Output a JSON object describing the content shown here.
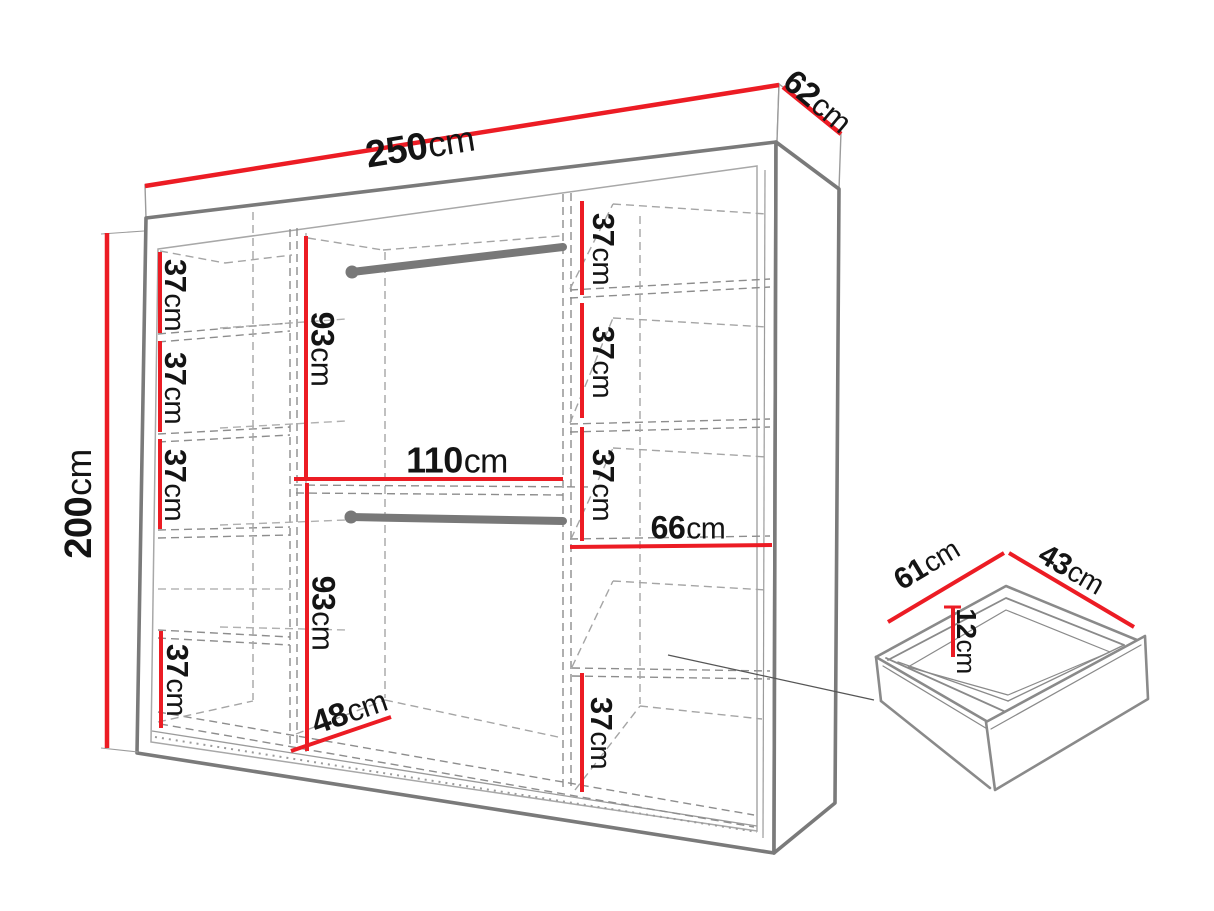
{
  "diagram_title": "wardrobe-dimension-diagram",
  "colors": {
    "dimension_red": "#ec1c24",
    "outline_gray": "#7a7a7a",
    "dash_gray": "#8d8d8d",
    "text_black": "#141414",
    "background": "#ffffff"
  },
  "wardrobe": {
    "width": {
      "num": "250",
      "unit": "cm"
    },
    "depth": {
      "num": "62",
      "unit": "cm"
    },
    "height": {
      "num": "200",
      "unit": "cm"
    },
    "left_column_shelves": [
      {
        "num": "37",
        "unit": "cm"
      },
      {
        "num": "37",
        "unit": "cm"
      },
      {
        "num": "37",
        "unit": "cm"
      },
      {
        "num": "37",
        "unit": "cm"
      }
    ],
    "middle_column": {
      "upper_height": {
        "num": "93",
        "unit": "cm"
      },
      "lower_height": {
        "num": "93",
        "unit": "cm"
      },
      "width": {
        "num": "110",
        "unit": "cm"
      },
      "floor_depth": {
        "num": "48",
        "unit": "cm"
      }
    },
    "right_column_shelves": [
      {
        "num": "37",
        "unit": "cm"
      },
      {
        "num": "37",
        "unit": "cm"
      },
      {
        "num": "37",
        "unit": "cm"
      },
      {
        "num": "37",
        "unit": "cm"
      }
    ],
    "right_column_shelf_width": {
      "num": "66",
      "unit": "cm"
    }
  },
  "drawer": {
    "front_edge": {
      "num": "61",
      "unit": "cm"
    },
    "side_edge": {
      "num": "43",
      "unit": "cm"
    },
    "inner_height": {
      "num": "12",
      "unit": "cm"
    }
  }
}
